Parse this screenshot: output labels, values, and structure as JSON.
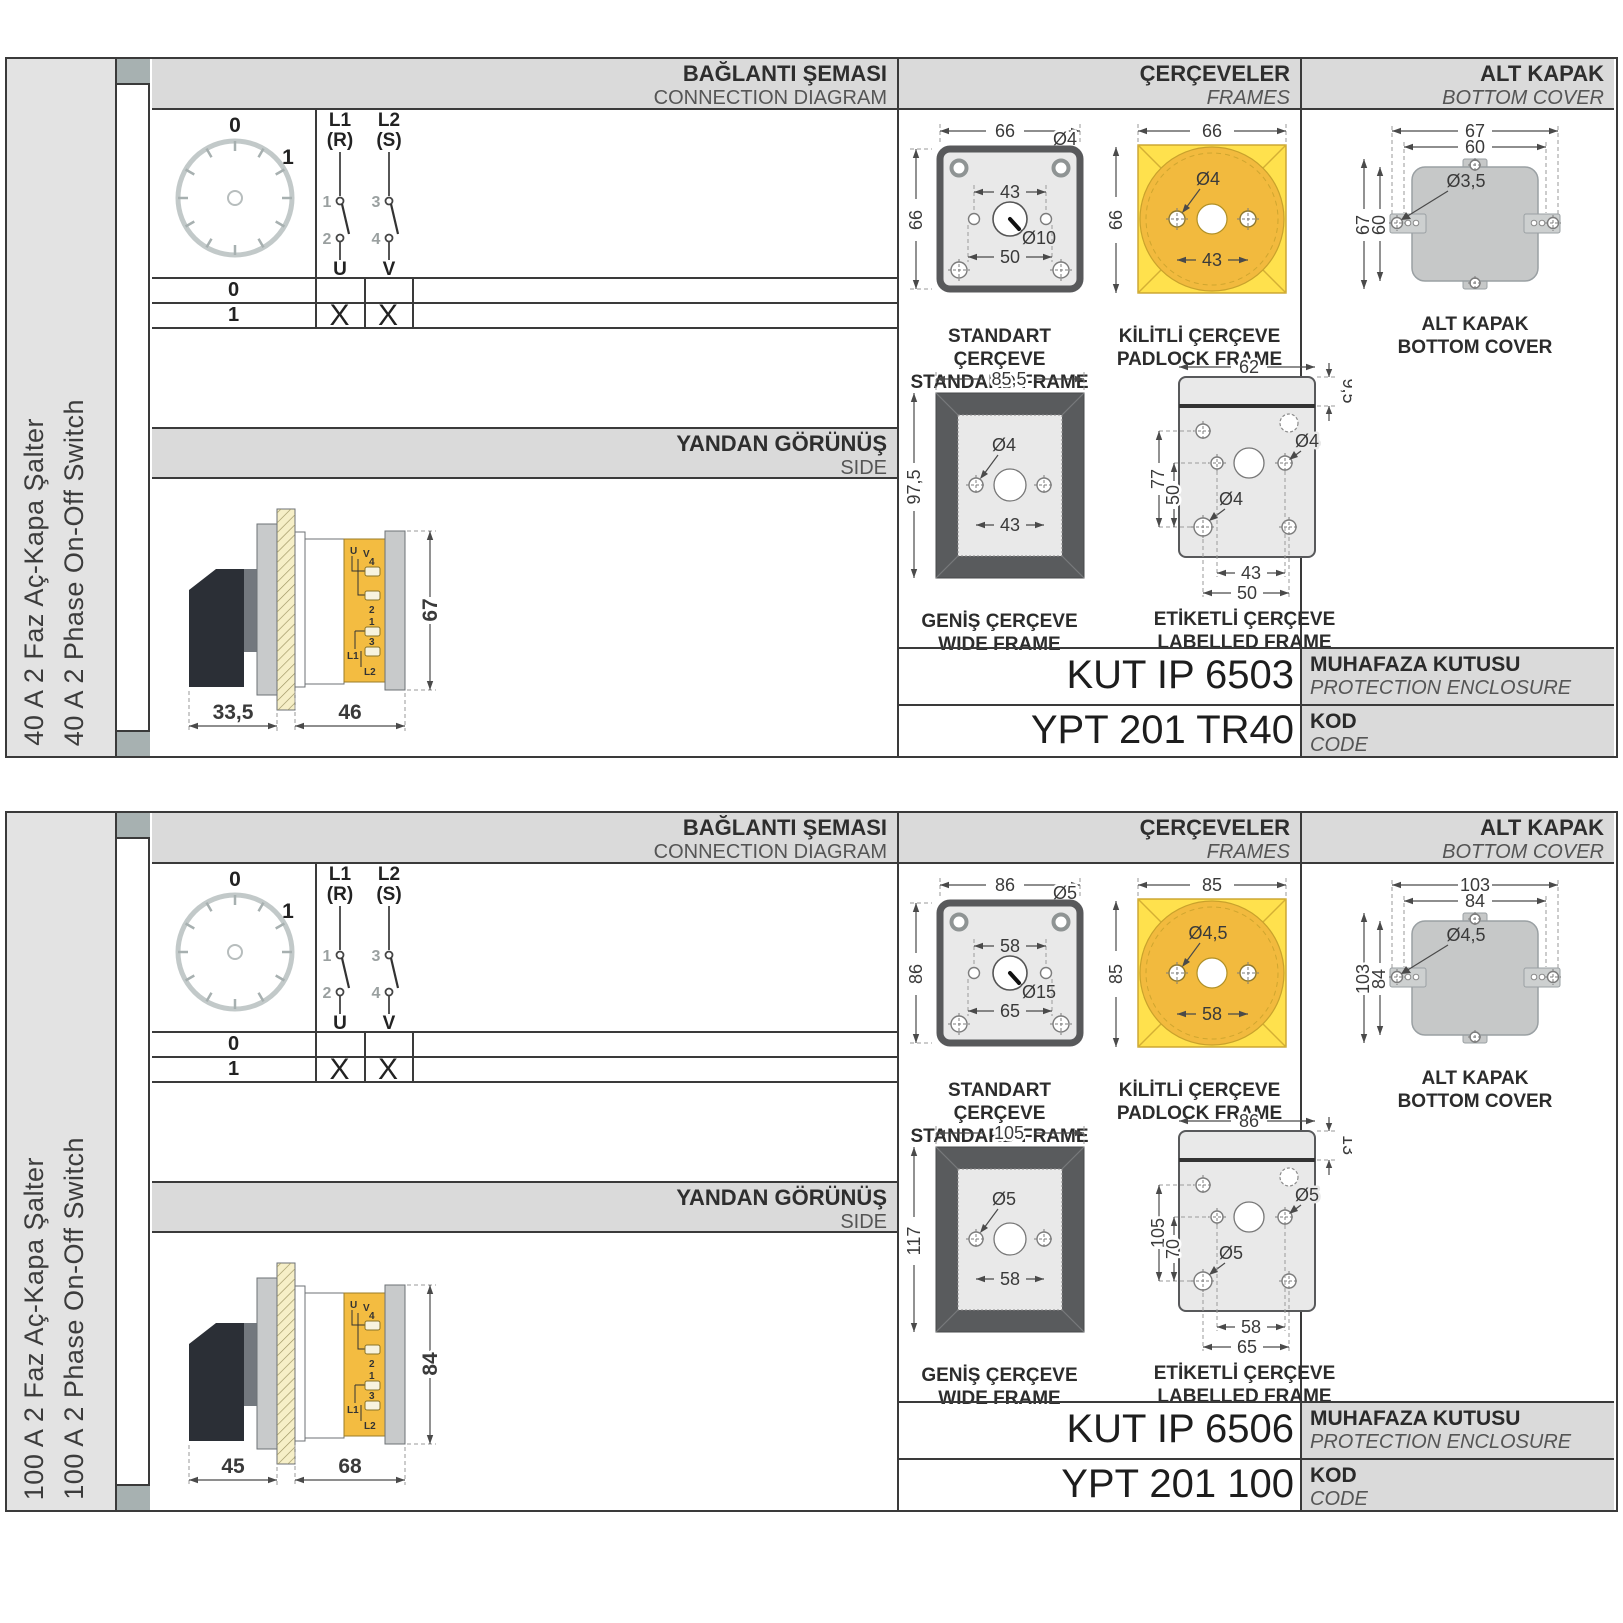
{
  "colors": {
    "accent_yellow": "#ffe14d",
    "amber_circle": "#f2ba3e",
    "header_gray": "#dadada",
    "tab_gray": "#a7b1b1",
    "drawing_dark_gray": "#595b5d",
    "handle_black": "#2b2f36",
    "body_yellow": "#f3bc41"
  },
  "panels": [
    {
      "sidebar": {
        "title_tr": "40 A 2 Faz Aç-Kapa Şalter",
        "title_en": "40 A 2 Phase On-Off Switch"
      },
      "headers": {
        "connection_tr": "BAĞLANTI ŞEMASI",
        "connection_en": "CONNECTION DIAGRAM",
        "frames_tr": "ÇERÇEVELER",
        "frames_en": "FRAMES",
        "cover_tr": "ALT KAPAK",
        "cover_en": "BOTTOM COVER",
        "side_tr": "YANDAN GÖRÜNÜŞ",
        "side_en": "SIDE"
      },
      "connection": {
        "dial": {
          "pos0": "0",
          "pos1": "1"
        },
        "poles": [
          {
            "line1": "L1",
            "line2": "(R)",
            "c1": "1",
            "c2": "2",
            "out": "U"
          },
          {
            "line1": "L2",
            "line2": "(S)",
            "c1": "3",
            "c2": "4",
            "out": "V"
          }
        ],
        "rows": [
          {
            "label": "0",
            "u": "",
            "v": ""
          },
          {
            "label": "1",
            "u": "X",
            "v": "X"
          }
        ]
      },
      "side_view": {
        "dim_a": "33,5",
        "dim_b": "46",
        "dim_h": "67",
        "t_u": "U",
        "t_v": "V",
        "t1": "1",
        "t2": "2",
        "t3": "3",
        "t4": "4",
        "l1": "L1",
        "l2": "L2"
      },
      "frames": {
        "standard": {
          "cap_tr": "STANDART ÇERÇEVE",
          "cap_en": "STANDARD FRAME",
          "w": "66",
          "h": "66",
          "hole": "Ø4",
          "inner": "43",
          "shaft": "Ø10",
          "lower": "50"
        },
        "padlock": {
          "cap_tr": "KİLİTLİ ÇERÇEVE",
          "cap_en": "PADLOCK FRAME",
          "w": "66",
          "h": "66",
          "hole": "Ø4",
          "inner": "43"
        },
        "wide": {
          "cap_tr": "GENİŞ ÇERÇEVE",
          "cap_en": "WIDE FRAME",
          "w": "85,5",
          "h": "97,5",
          "hole": "Ø4",
          "inner": "43"
        },
        "labelled": {
          "cap_tr": "ETİKETLİ ÇERÇEVE",
          "cap_en": "LABELLED FRAME",
          "w": "62",
          "h": "77",
          "h2": "50",
          "strip": "9,5",
          "hole": "Ø4",
          "hole2": "Ø4",
          "inner": "43",
          "lower": "50"
        }
      },
      "cover": {
        "cap_tr": "ALT KAPAK",
        "cap_en": "BOTTOM COVER",
        "w1": "67",
        "w2": "60",
        "h1": "67",
        "h2": "60",
        "hole": "Ø3,5"
      },
      "codes": {
        "enclosure_value": "KUT IP 6503",
        "enclosure_tr": "MUHAFAZA KUTUSU",
        "enclosure_en": "PROTECTION ENCLOSURE",
        "code_value": "YPT 201 TR40",
        "code_tr": "KOD",
        "code_en": "CODE"
      }
    },
    {
      "sidebar": {
        "title_tr": "100 A 2 Faz Aç-Kapa Şalter",
        "title_en": "100 A 2 Phase On-Off Switch"
      },
      "headers": {
        "connection_tr": "BAĞLANTI ŞEMASI",
        "connection_en": "CONNECTION DIAGRAM",
        "frames_tr": "ÇERÇEVELER",
        "frames_en": "FRAMES",
        "cover_tr": "ALT KAPAK",
        "cover_en": "BOTTOM COVER",
        "side_tr": "YANDAN GÖRÜNÜŞ",
        "side_en": "SIDE"
      },
      "connection": {
        "dial": {
          "pos0": "0",
          "pos1": "1"
        },
        "poles": [
          {
            "line1": "L1",
            "line2": "(R)",
            "c1": "1",
            "c2": "2",
            "out": "U"
          },
          {
            "line1": "L2",
            "line2": "(S)",
            "c1": "3",
            "c2": "4",
            "out": "V"
          }
        ],
        "rows": [
          {
            "label": "0",
            "u": "",
            "v": ""
          },
          {
            "label": "1",
            "u": "X",
            "v": "X"
          }
        ]
      },
      "side_view": {
        "dim_a": "45",
        "dim_b": "68",
        "dim_h": "84",
        "t_u": "U",
        "t_v": "V",
        "t1": "1",
        "t2": "2",
        "t3": "3",
        "t4": "4",
        "l1": "L1",
        "l2": "L2"
      },
      "frames": {
        "standard": {
          "cap_tr": "STANDART ÇERÇEVE",
          "cap_en": "STANDARD FRAME",
          "w": "86",
          "h": "86",
          "hole": "Ø5",
          "inner": "58",
          "shaft": "Ø15",
          "lower": "65"
        },
        "padlock": {
          "cap_tr": "KİLİTLİ ÇERÇEVE",
          "cap_en": "PADLOCK FRAME",
          "w": "85",
          "h": "85",
          "hole": "Ø4,5",
          "inner": "58"
        },
        "wide": {
          "cap_tr": "GENİŞ ÇERÇEVE",
          "cap_en": "WIDE FRAME",
          "w": "105",
          "h": "117",
          "hole": "Ø5",
          "inner": "58"
        },
        "labelled": {
          "cap_tr": "ETİKETLİ ÇERÇEVE",
          "cap_en": "LABELLED FRAME",
          "w": "86",
          "h": "105",
          "h2": "70",
          "strip": "13",
          "hole": "Ø5",
          "hole2": "Ø5",
          "inner": "58",
          "lower": "65"
        }
      },
      "cover": {
        "cap_tr": "ALT KAPAK",
        "cap_en": "BOTTOM COVER",
        "w1": "103",
        "w2": "84",
        "h1": "103",
        "h2": "84",
        "hole": "Ø4,5"
      },
      "codes": {
        "enclosure_value": "KUT IP 6506",
        "enclosure_tr": "MUHAFAZA KUTUSU",
        "enclosure_en": "PROTECTION ENCLOSURE",
        "code_value": "YPT 201 100",
        "code_tr": "KOD",
        "code_en": "CODE"
      }
    }
  ]
}
